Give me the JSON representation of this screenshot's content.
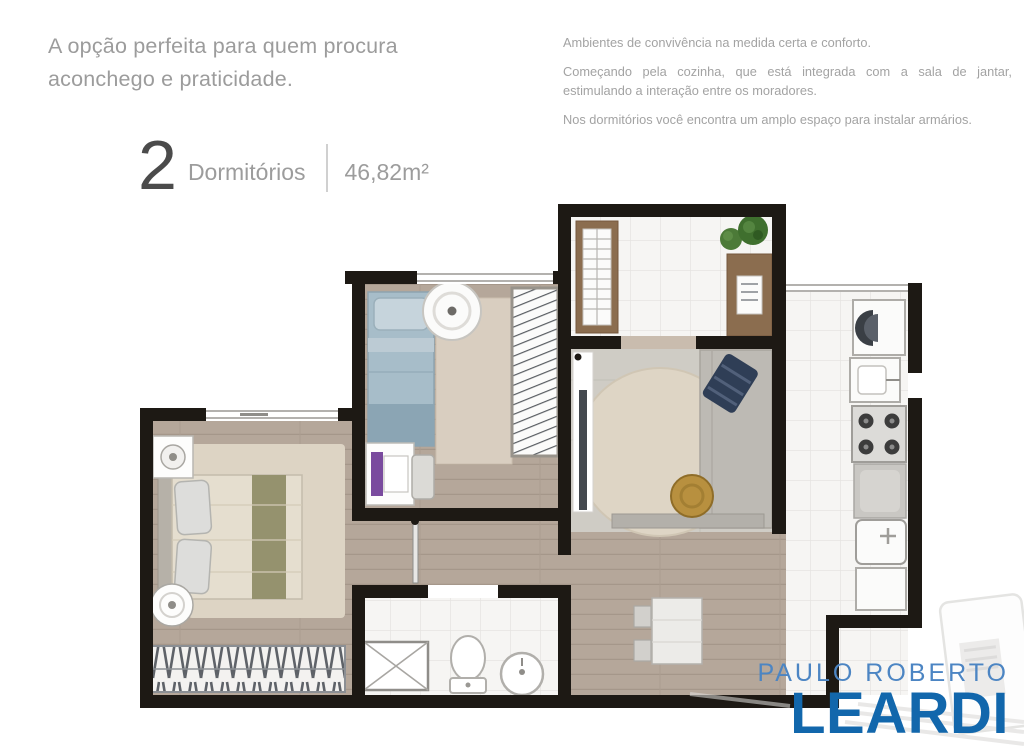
{
  "intro": {
    "headline": "A opção perfeita para quem procura aconchego e praticidade.",
    "paragraphs": [
      "Ambientes de convivência na medida certa e conforto.",
      "Começando pela cozinha, que está integrada com a sala de jantar, estimulando a interação entre os moradores.",
      "Nos dormitórios você encontra um amplo espaço para instalar armários."
    ]
  },
  "unit_info": {
    "bedrooms_count": "2",
    "bedrooms_label": "Dormitórios",
    "area": "46,82m²"
  },
  "logo": {
    "top": "PAULO ROBERTO",
    "bottom": "LEARDI"
  },
  "theme": {
    "text-muted": "#9c9c9c",
    "text-body": "#a3a3a3",
    "numeral": "#4b4b4b",
    "divider": "#d0d0d0",
    "logo-light": "#4c85c3",
    "logo-dark": "#1267ac",
    "wall": "#1d1914",
    "wood": "#b5a79a",
    "tile": "#f6f5f3",
    "carpet": "#d9cec0",
    "living-floor": "#cfccc5",
    "brown": "#8b6d4f",
    "bed-blue": "#a7bdc9",
    "navy": "#2f3e56",
    "gold": "#b8903f",
    "olive": "#95926e",
    "cream": "#e5decf"
  }
}
